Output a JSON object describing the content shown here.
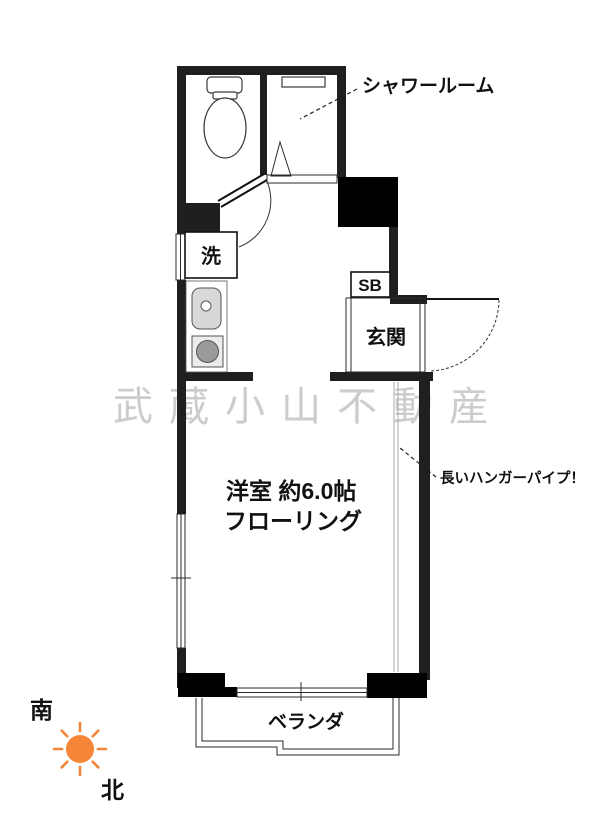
{
  "labels": {
    "shower_room": "シャワールーム",
    "washer": "洗",
    "shoebox": "SB",
    "entrance": "玄関",
    "room_size": "洋室 約6.0帖",
    "room_floor": "フローリング",
    "hanger_pipe_note": "長いハンガーパイプ！",
    "veranda": "ベランダ"
  },
  "compass": {
    "south": "南",
    "north": "北"
  },
  "watermark": "武蔵小山不動産",
  "colors": {
    "wall": "#1f1f1f",
    "pillar": "#000000",
    "sun_orange": "#f58638",
    "watermark_gray": "#c4c4c4"
  }
}
